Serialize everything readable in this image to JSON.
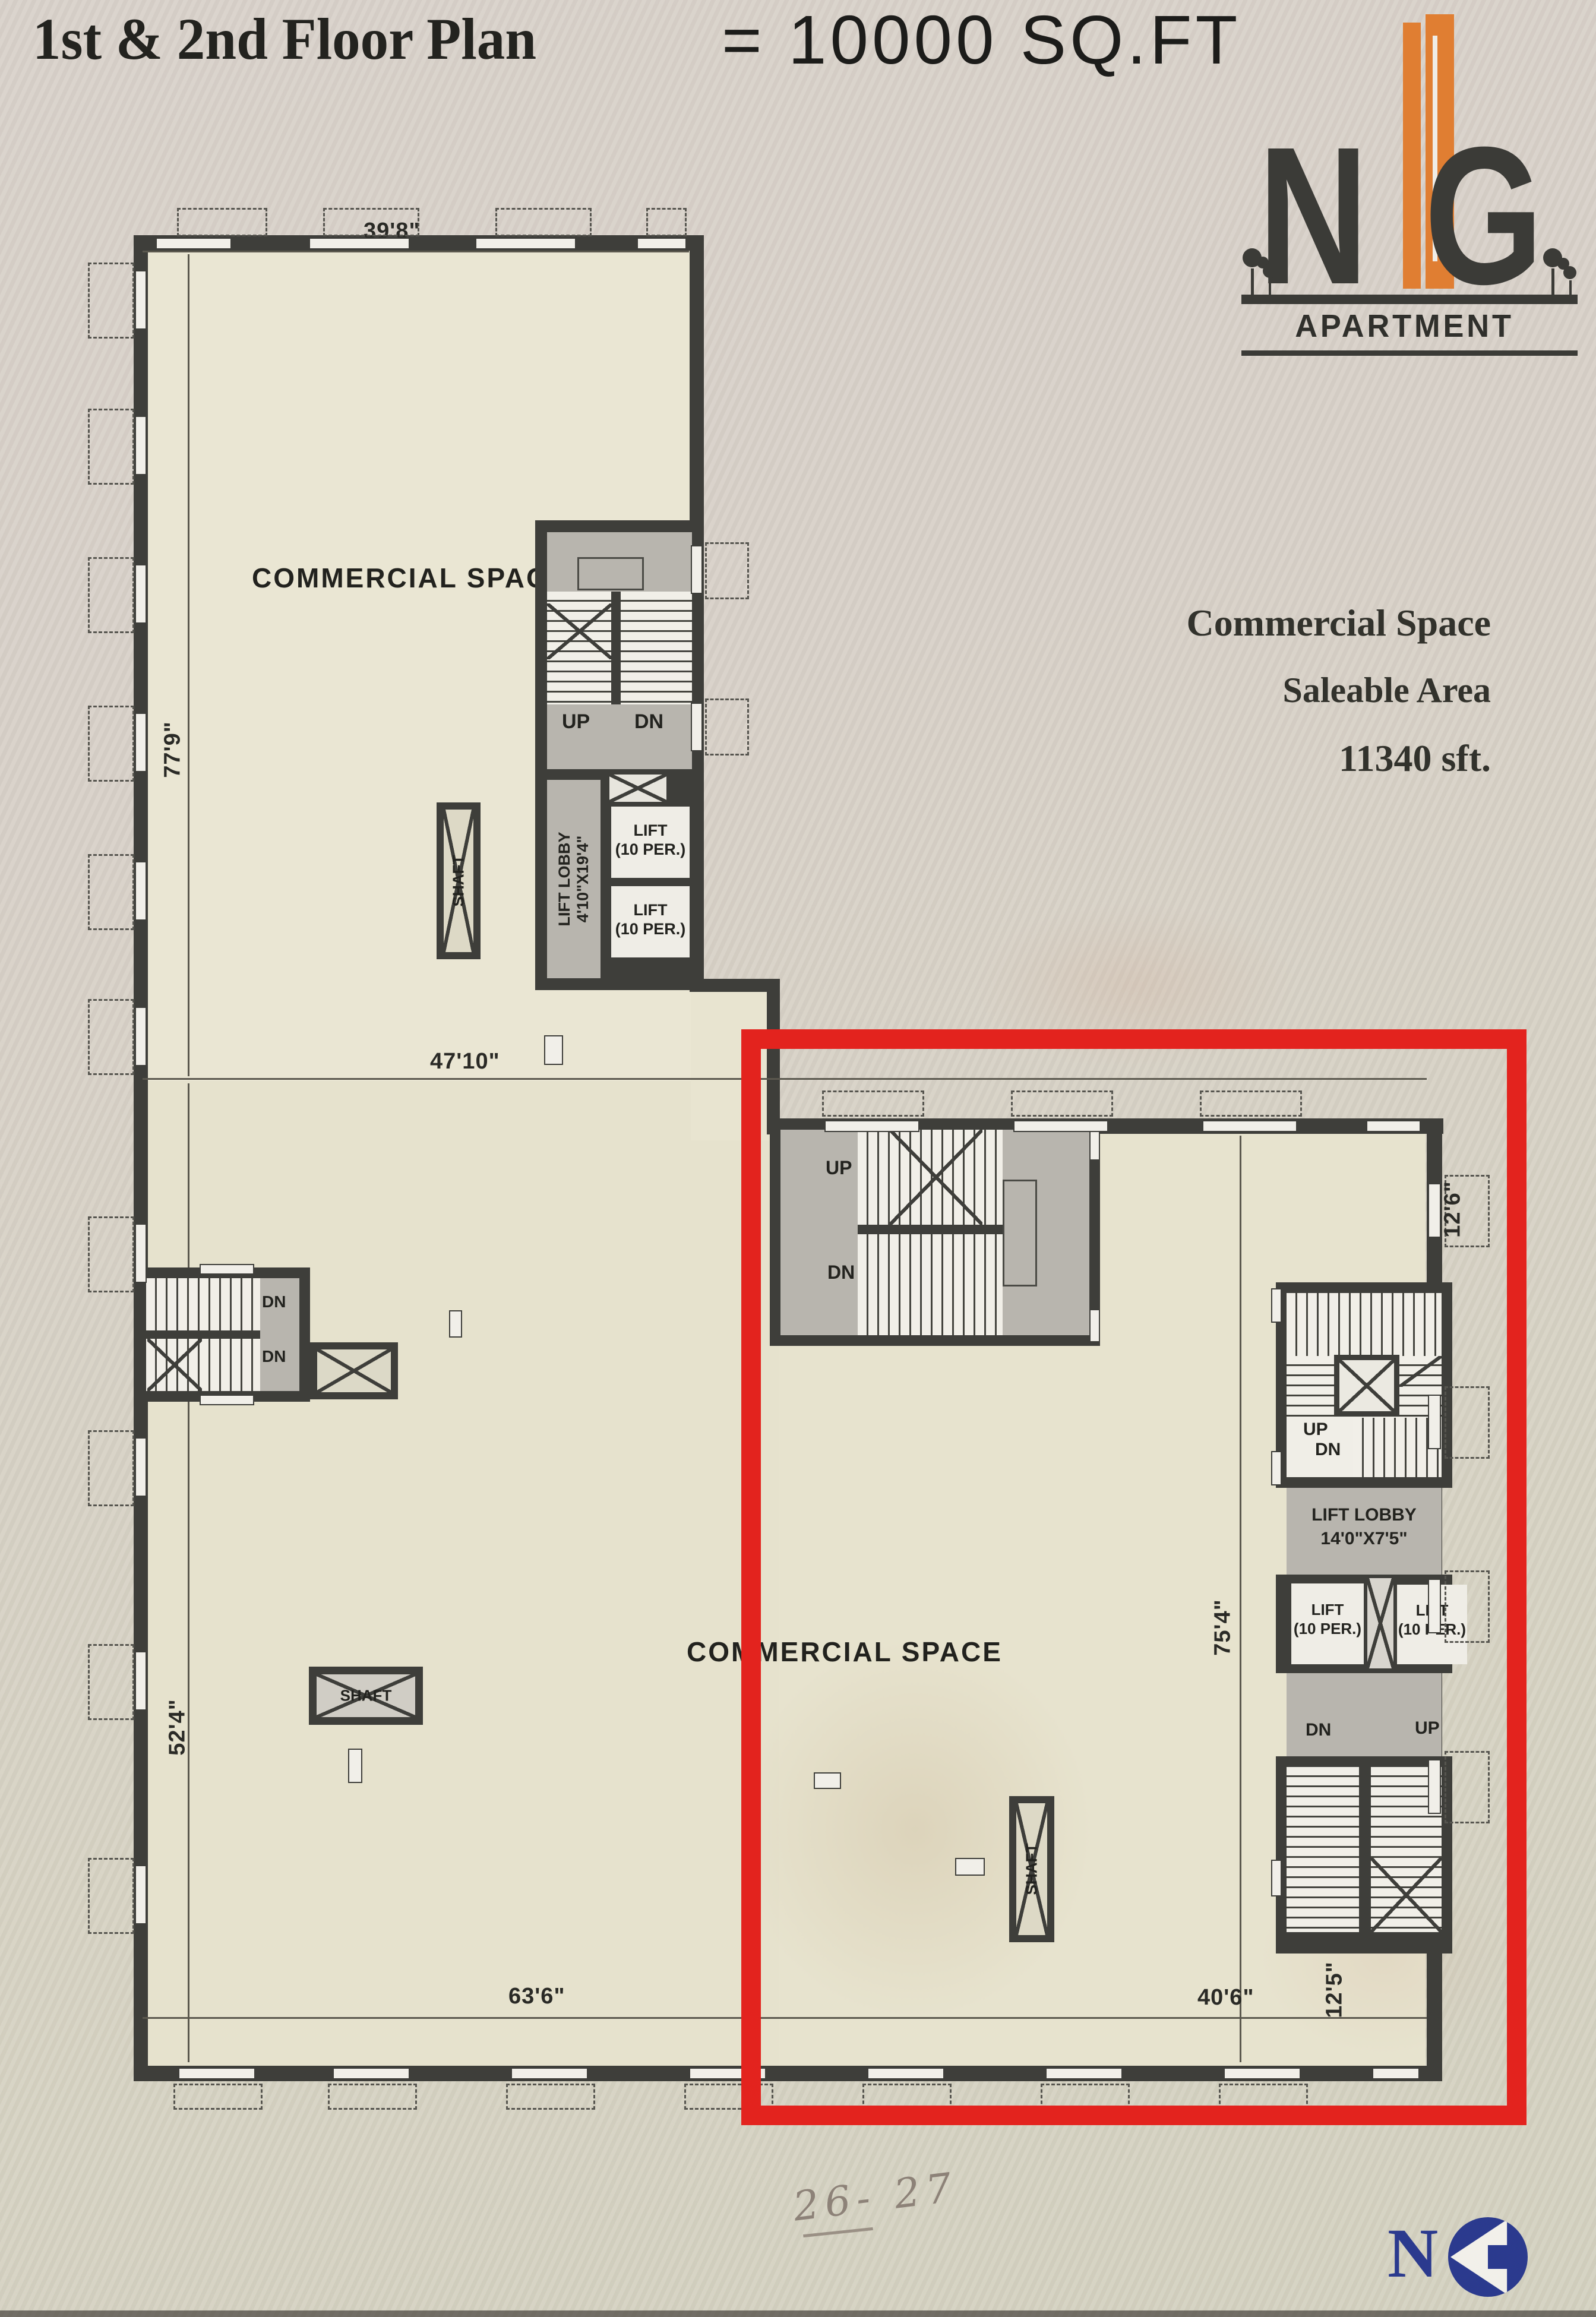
{
  "title": {
    "plan_name": "1st & 2nd Floor Plan",
    "annotation": "= 10000 SQ.FT"
  },
  "brand": {
    "letter_n": "N",
    "letter_g": "G",
    "name": "APARTMENT"
  },
  "info": {
    "line1": "Commercial Space",
    "line2": "Saleable Area",
    "line3": "11340 sft."
  },
  "rooms": {
    "commercial_space": "COMMERCIAL SPACE",
    "shaft": "SHAFT",
    "lift_lobby_main": {
      "name": "LIFT LOBBY",
      "size": "4'10\"X19'4\""
    },
    "lift_lobby_right": {
      "name": "LIFT LOBBY",
      "size": "14'0\"X7'5\""
    },
    "lift": {
      "name": "LIFT",
      "capacity": "(10 PER.)"
    }
  },
  "stairs": {
    "up": "UP",
    "dn": "DN"
  },
  "dimensions": {
    "top_width": "39'8\"",
    "upper_left_height": "77'9\"",
    "middle_width": "47'10\"",
    "lower_left_height": "52'4\"",
    "bottom_left_width": "63'6\"",
    "bottom_right_width": "40'6\"",
    "right_top_height": "12'6\"",
    "right_mid_height": "75'4\"",
    "bottom_right_height": "12'5\""
  },
  "note": {
    "handwritten": "26- 27"
  },
  "footer": {
    "logo_letter": "N"
  },
  "colors": {
    "red_highlight": "#e3231e",
    "accent_orange": "#e07e32",
    "navy": "#2b3a8e",
    "wall": "#3e3e3a",
    "floor": "#eae6d3"
  }
}
